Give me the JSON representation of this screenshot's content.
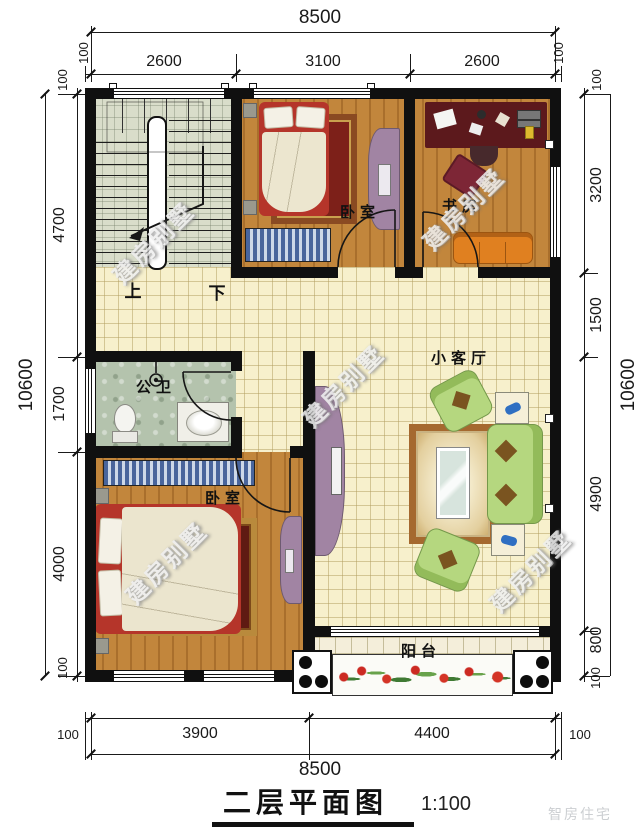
{
  "title": {
    "name": "二层平面图",
    "scale": "1:100"
  },
  "dims": {
    "top": {
      "overall": "8500",
      "segments": [
        "100",
        "2600",
        "3100",
        "2600",
        "100"
      ]
    },
    "bottom": {
      "overall": "8500",
      "segments": [
        "100",
        "3900",
        "4400",
        "100"
      ]
    },
    "left": {
      "overall": "10600",
      "segments": [
        "100",
        "4700",
        "1700",
        "4000",
        "100"
      ]
    },
    "right": {
      "overall": "10600",
      "segments": [
        "100",
        "3200",
        "1500",
        "4900",
        "800",
        "100"
      ]
    }
  },
  "rooms": {
    "bedroom_top": "卧室",
    "study": "书房",
    "bathroom": "公卫",
    "living": "小客厅",
    "bedroom_bottom": "卧室",
    "balcony": "阳台"
  },
  "stairs": {
    "up": "上",
    "down": "下"
  },
  "watermark": {
    "text": "建房别墅"
  },
  "brand": {
    "text": "智房住宅"
  },
  "colors": {
    "wall": "#101010",
    "wood_floor": "#c2863c",
    "tile_floor": "#f7f0cc",
    "stair_floor": "#d9ddca",
    "bath_floor": "#b4c3ad",
    "sofa_green": "#b5d77f",
    "sofa_orange": "#e08020",
    "wardrobe_purple": "#a184a3",
    "bed_red": "#b5352a",
    "rug_red": "#7d2019",
    "desk_maroon": "#5c191c"
  }
}
